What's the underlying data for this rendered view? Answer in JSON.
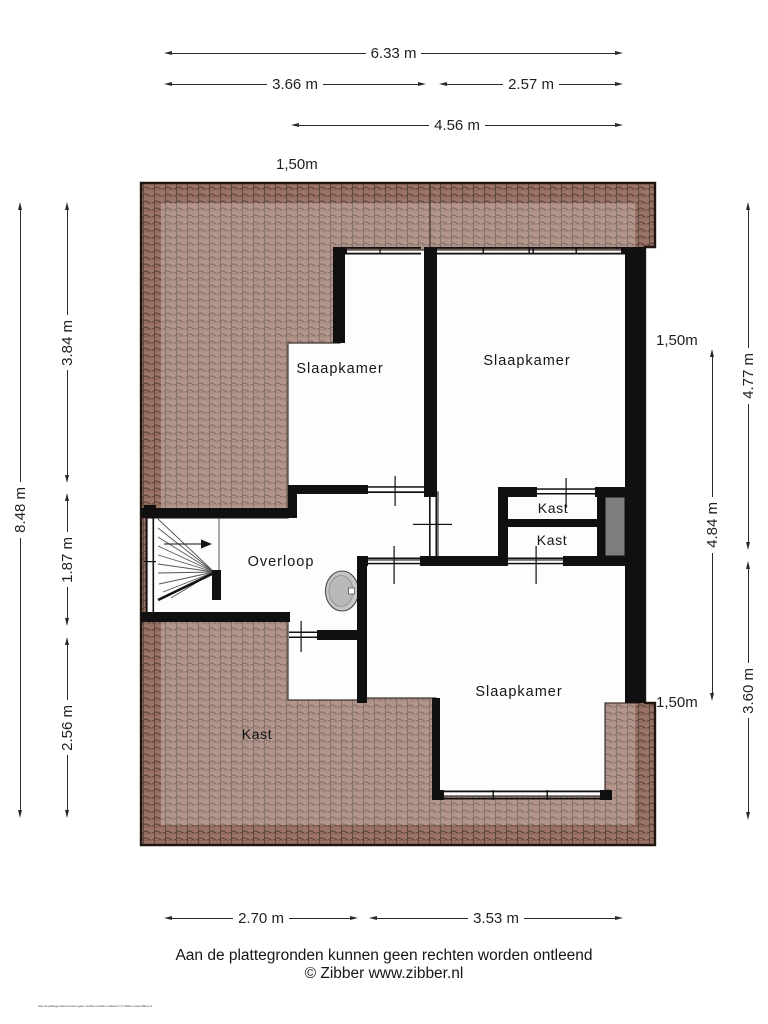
{
  "rooms": {
    "slaapkamer_tl": "Slaapkamer",
    "slaapkamer_tr": "Slaapkamer",
    "slaapkamer_bottom": "Slaapkamer",
    "overloop": "Overloop",
    "kast_1": "Kast",
    "kast_2": "Kast",
    "kast_attic": "Kast"
  },
  "dimensions": {
    "top": {
      "total": "6.33 m",
      "left": "3.66 m",
      "right": "2.57 m",
      "inner": "4.56 m",
      "height_line": "1,50m"
    },
    "left": {
      "total": "8.48 m",
      "upper": "3.84 m",
      "middle": "1.87 m",
      "lower": "2.56 m"
    },
    "right": {
      "outer_upper": "4.77 m",
      "inner": "4.84 m",
      "outer_lower": "3.60 m",
      "height_line_upper": "1,50m",
      "height_line_lower": "1,50m"
    },
    "bottom": {
      "left": "2.70 m",
      "right": "3.53 m"
    }
  },
  "footer": {
    "disclaimer": "Aan de plattegronden kunnen geen rechten worden ontleend",
    "copyright": "© Zibber www.zibber.nl",
    "micro_disclaimer": "Aan de plattegronden kunnen geen rechten worden ontleend | © Zibber www.zibber.nl"
  },
  "colors": {
    "roof_tile": "#9c7467",
    "roof_seam": "#4c3b33",
    "wall": "#101010",
    "shaft_gray": "#7d7d7d",
    "dimension_line": "#2a2a2a"
  }
}
